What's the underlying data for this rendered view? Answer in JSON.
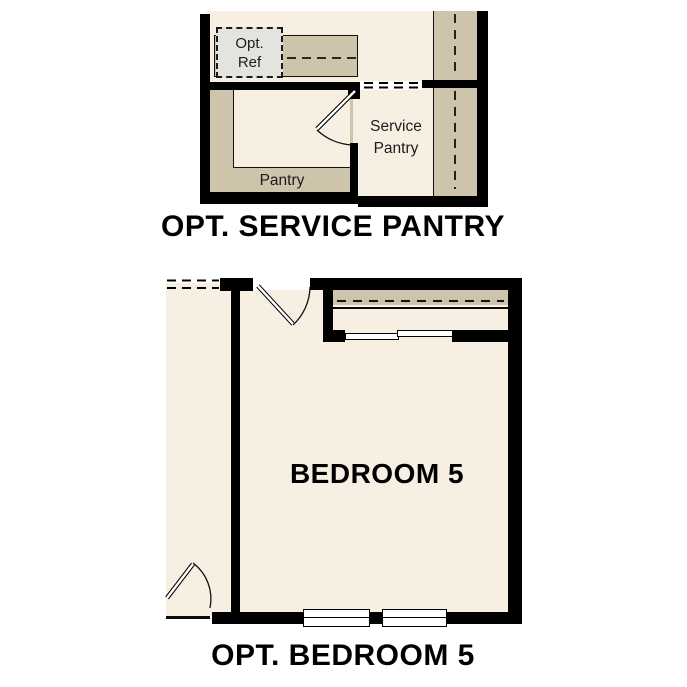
{
  "page": {
    "background": "#ffffff"
  },
  "colors": {
    "floor_cream": "#f6efe2",
    "cabinet_tan": "#cec4ab",
    "wall_black": "#000000",
    "opt_ref_gray": "#e3e3e0",
    "label_text": "#1c1c1c"
  },
  "plans": [
    {
      "id": "opt-service-pantry",
      "title": "OPT. SERVICE PANTRY",
      "labels": {
        "opt_ref_line1": "Opt.",
        "opt_ref_line2": "Ref",
        "service_pantry_line1": "Service",
        "service_pantry_line2": "Pantry",
        "pantry": "Pantry"
      }
    },
    {
      "id": "opt-bedroom-5",
      "title": "OPT. BEDROOM 5",
      "labels": {
        "room": "BEDROOM 5"
      }
    }
  ]
}
